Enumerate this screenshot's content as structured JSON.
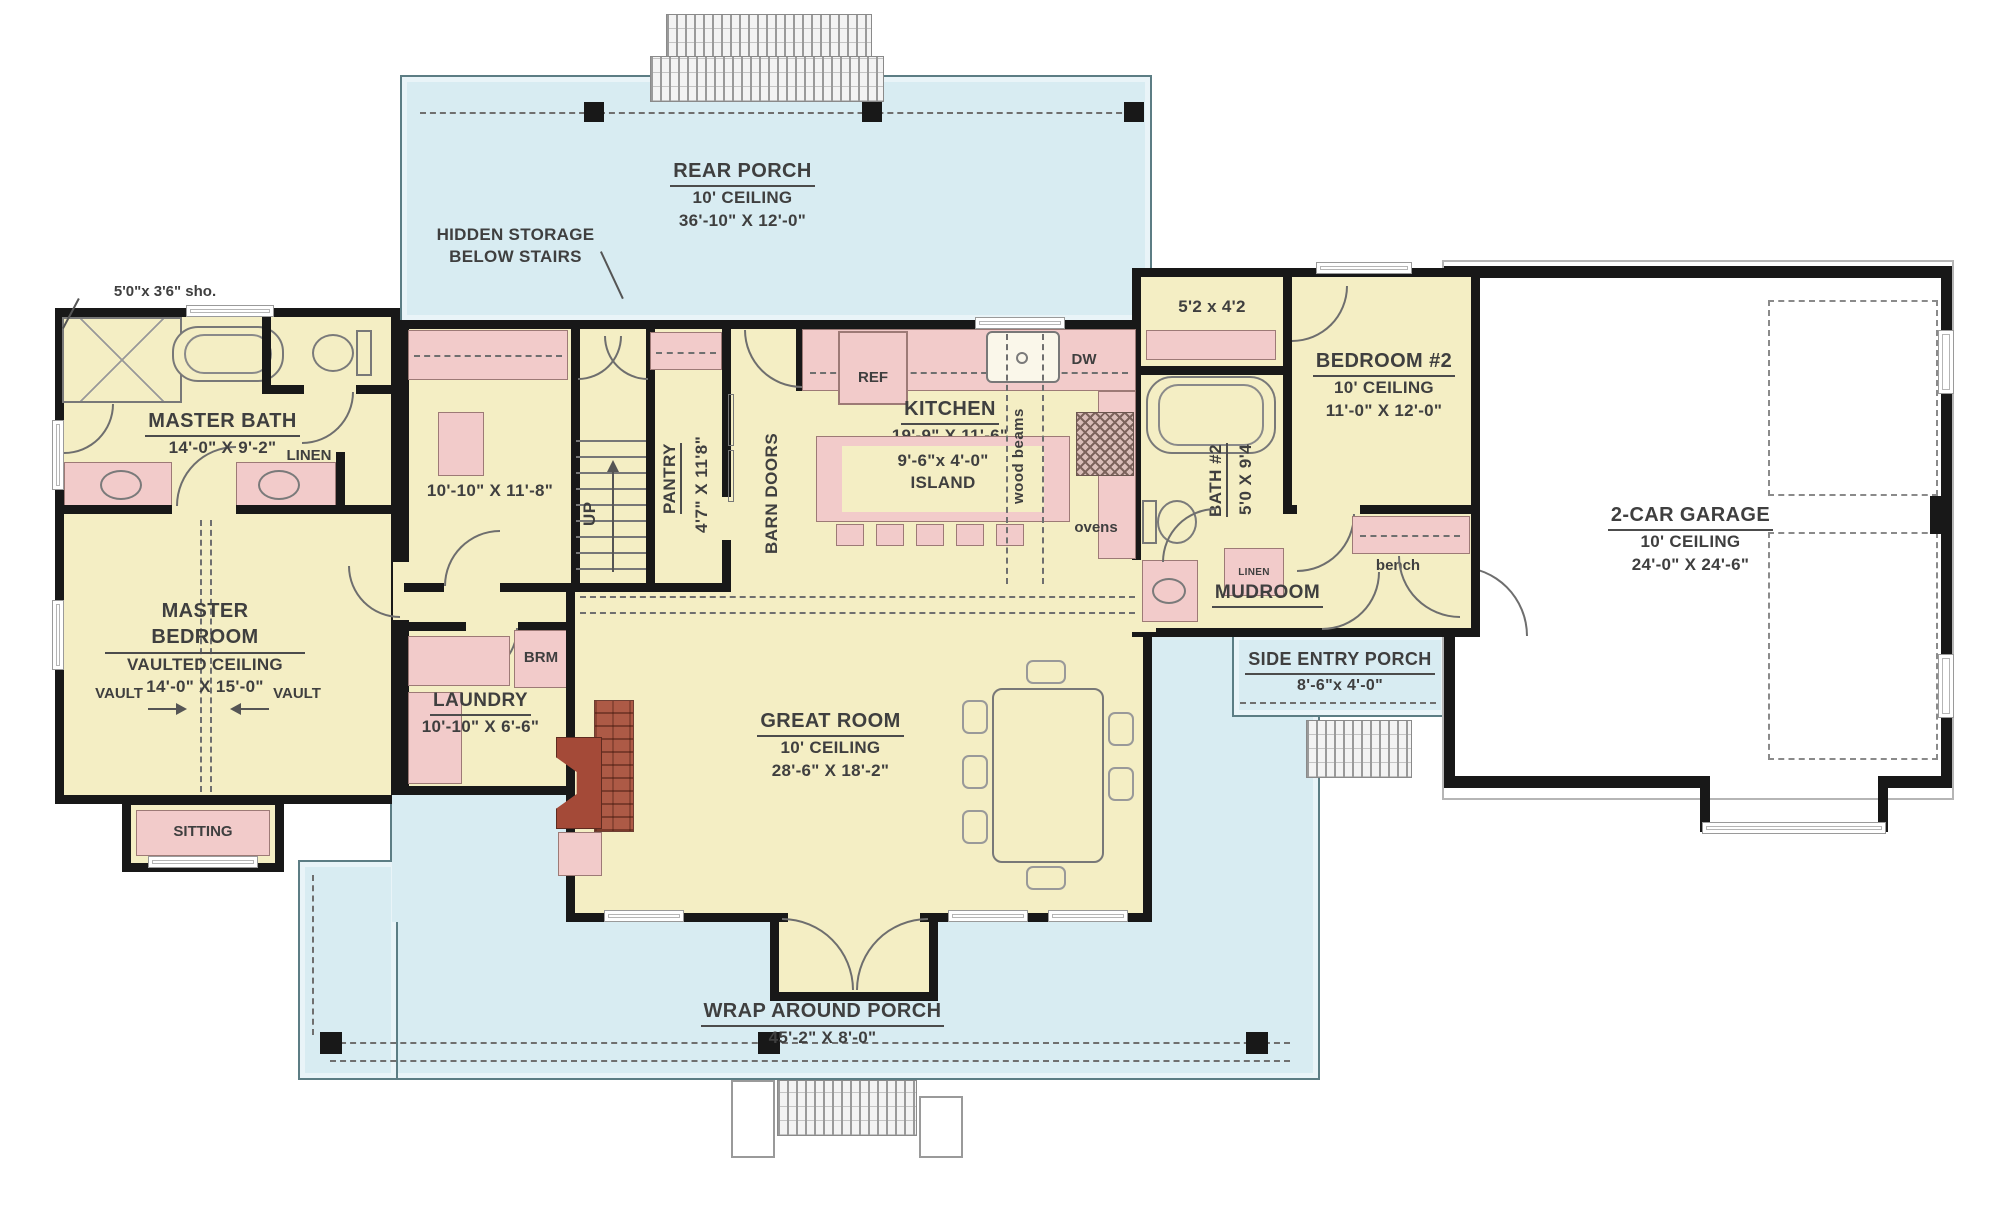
{
  "colors": {
    "porch": "#d8ecf2",
    "room": "#f4eec4",
    "fixture": "#f2cbca",
    "wall": "#181818",
    "brick": "#ad5a46",
    "text": "#3f3f3f"
  },
  "labels": {
    "rear_porch_name": "REAR PORCH",
    "rear_porch_ceiling": "10' CEILING",
    "rear_porch_dims": "36'-10\" X 12'-0\"",
    "hidden_storage_1": "HIDDEN STORAGE",
    "hidden_storage_2": "BELOW STAIRS",
    "shower_note": "5'0\"x 3'6\" sho.",
    "master_bath_name": "MASTER BATH",
    "master_bath_dims": "14'-0\" X 9'-2\"",
    "linen_master": "LINEN",
    "closet_master_dims": "10'-10\" X 11'-8\"",
    "pantry_name": "PANTRY",
    "pantry_dims": "4'7\" X 11'8\"",
    "barn_doors": "BARN DOORS",
    "up": "UP",
    "kitchen_name": "KITCHEN",
    "kitchen_dims": "19'-9\" X 11'-6\"",
    "ref": "REF",
    "dw": "DW",
    "wood_beams": "wood beams",
    "ovens": "ovens",
    "island_dims": "9'-6\"x 4'-0\"",
    "island_name": "ISLAND",
    "closet2_dims": "5'2 x 4'2",
    "bedroom2_name": "BEDROOM #2",
    "bedroom2_ceiling": "10' CEILING",
    "bedroom2_dims": "11'-0\" X 12'-0\"",
    "bath2_name": "BATH #2",
    "bath2_dims": "5'0 X 9'4",
    "linen2": "LINEN",
    "garage_name": "2-CAR GARAGE",
    "garage_ceiling": "10' CEILING",
    "garage_dims": "24'-0\" X 24'-6\"",
    "master_bedroom_name": "MASTER BEDROOM",
    "master_bedroom_ceiling": "VAULTED CEILING",
    "master_bedroom_dims": "14'-0\" X 15'-0\"",
    "vault_left": "VAULT",
    "vault_right": "VAULT",
    "sitting": "SITTING",
    "laundry_name": "LAUNDRY",
    "laundry_dims": "10'-10\" X 6'-6\"",
    "brm": "BRM",
    "great_room_name": "GREAT ROOM",
    "great_room_ceiling": "10' CEILING",
    "great_room_dims": "28'-6\" X 18'-2\"",
    "mudroom": "MUDROOM",
    "bench": "bench",
    "side_porch_name": "SIDE ENTRY PORCH",
    "side_porch_dims": "8'-6\"x 4'-0\"",
    "wrap_porch_name": "WRAP AROUND PORCH",
    "wrap_porch_dims": "45'-2\" X 8'-0\""
  }
}
